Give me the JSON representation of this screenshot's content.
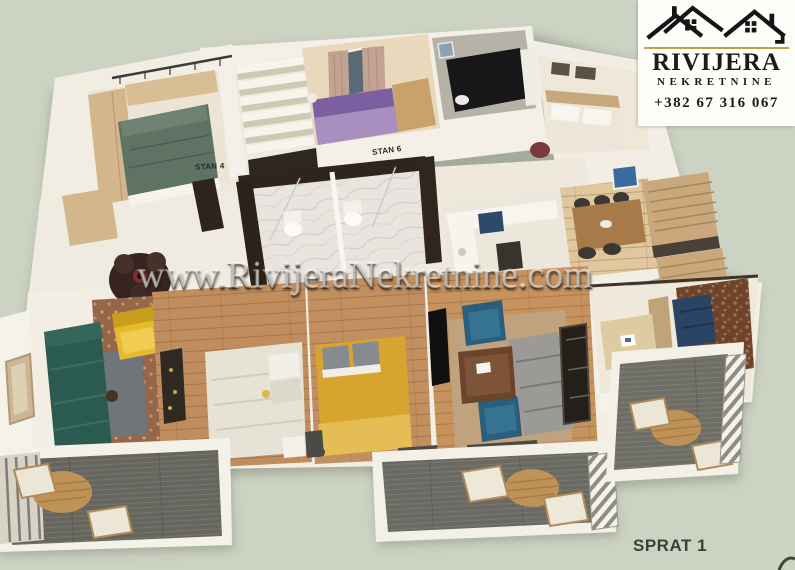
{
  "watermark": {
    "text": "www.RivijeraNekretnine.com"
  },
  "logo": {
    "title": "RIVIJERA",
    "subtitle": "NEKRETNINE",
    "phone": "+382 67 316 067",
    "icon": "twin-houses-icon",
    "accent_color": "#c2a14e",
    "background_color": "#fdfdf9",
    "text_color": "#1b1b19"
  },
  "plan": {
    "floor_label": "SPRAT 1",
    "unit_labels": [
      "STAN 4",
      "STAN 6",
      "STAN 5"
    ]
  },
  "colors": {
    "page_background": "#cdd3c3",
    "walls": "#f2eee4",
    "wood_floor": "#c28e5e",
    "balcony_deck": "#68685f",
    "teal_sofa": "#2b5a50",
    "yellow_armchair": "#e5ba2e",
    "mustard_bed": "#d7a52f",
    "purple_bed": "#7c5fa0"
  }
}
